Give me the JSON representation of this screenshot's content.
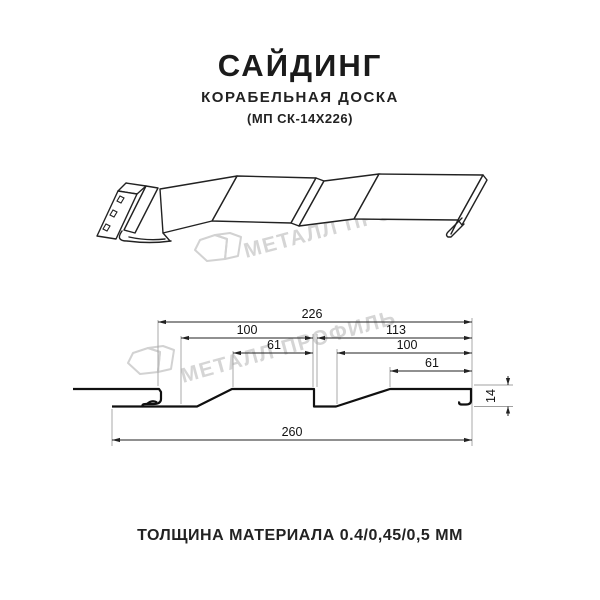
{
  "header": {
    "title": "САЙДИНГ",
    "subtitle": "КОРАБЕЛЬНАЯ ДОСКА",
    "code": "(МП СК-14Х226)"
  },
  "watermark": {
    "brand": "МЕТАЛЛ ПРОФИЛЬ"
  },
  "diagram": {
    "type": "siding-profile-technical-drawing",
    "dimensions": {
      "overall_width": "226",
      "left_panel": "100",
      "right_panel": "113",
      "left_flat": "61",
      "right_inner": "100",
      "right_flat": "61",
      "total_width": "260",
      "height": "14"
    }
  },
  "footer": {
    "note": "ТОЛЩИНА МАТЕРИАЛА 0.4/0,45/0,5 ММ"
  }
}
